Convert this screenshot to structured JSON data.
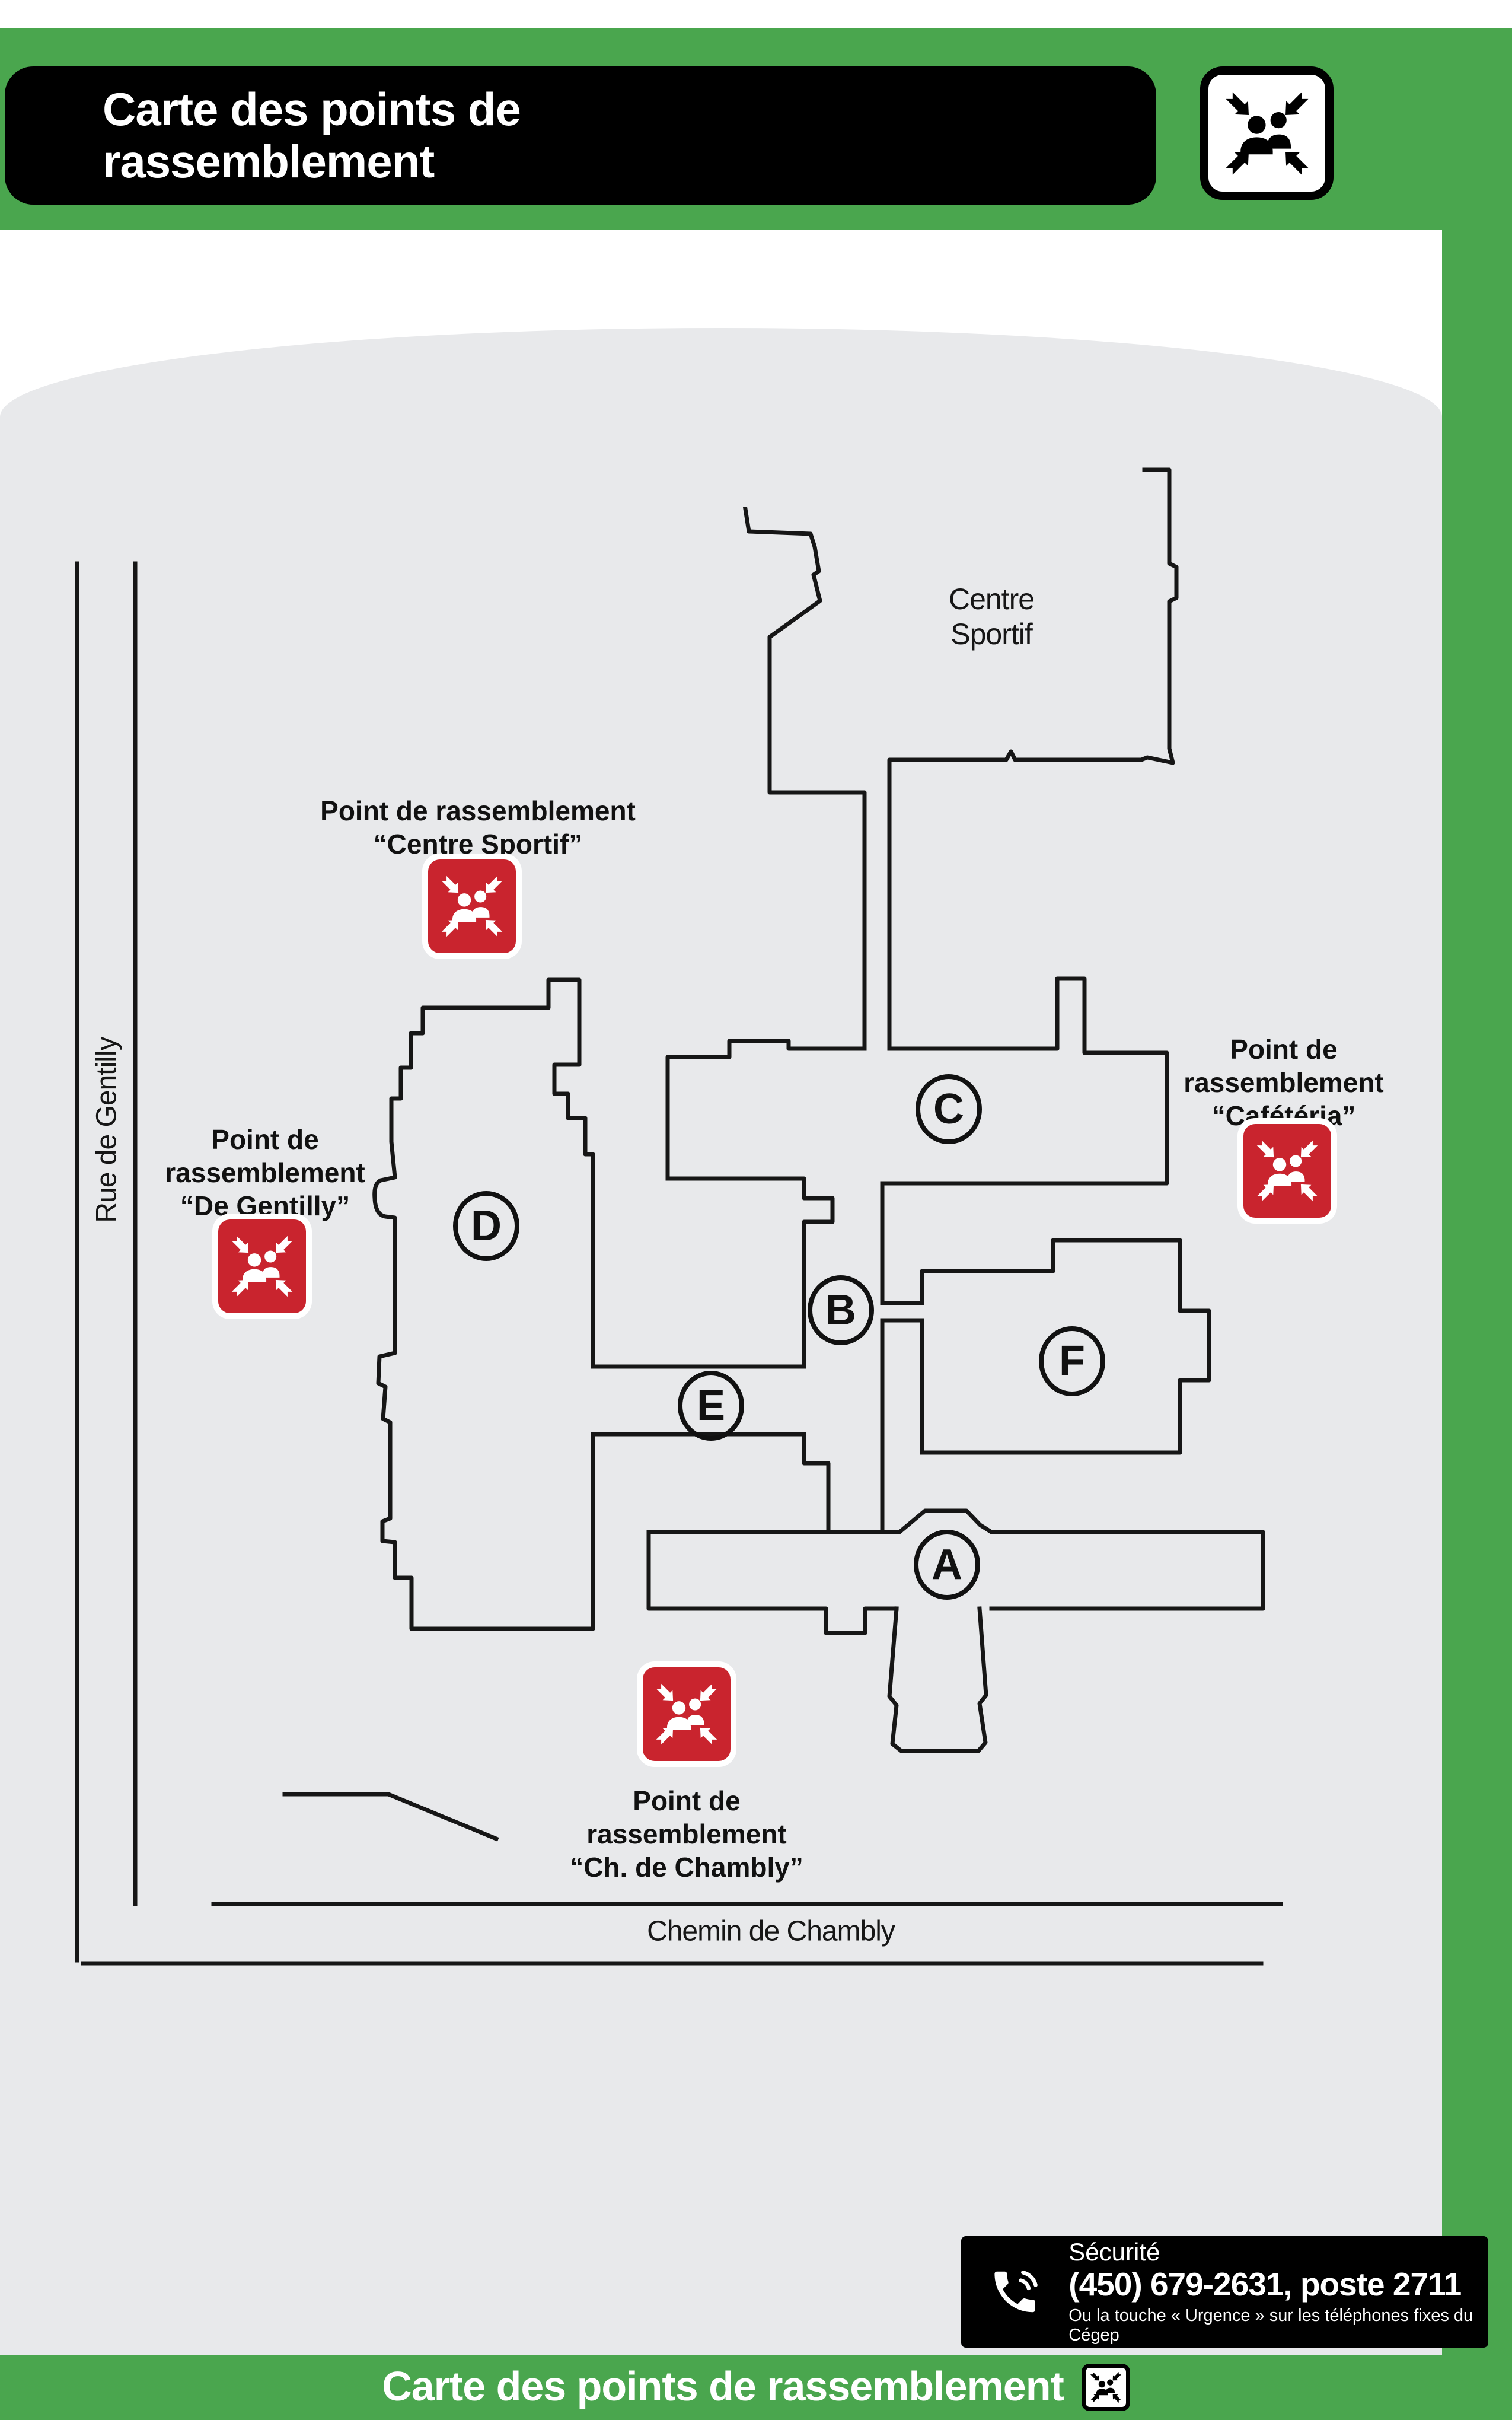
{
  "header": {
    "title_lines": [
      "Carte des points de",
      "rassemblement"
    ]
  },
  "map": {
    "place_label": "Centre\nSportif",
    "streets": {
      "vertical": "Rue de Gentilly",
      "horizontal": "Chemin de Chambly"
    },
    "buildings": [
      "A",
      "B",
      "C",
      "D",
      "E",
      "F"
    ],
    "assembly_points": {
      "centre_sportif": "Point de rassemblement\n“Centre Sportif”",
      "de_gentilly": "Point de\nrassemblement\n“De Gentilly”",
      "cafeteria": "Point de\nrassemblement\n“Cafétéria”",
      "chambly": "Point de\nrassemblement\n“Ch. de Chambly”"
    }
  },
  "security": {
    "title": "Sécurité",
    "phone": "(450) 679-2631, poste 2711",
    "note": "Ou la touche « Urgence » sur les téléphones fixes du Cégep"
  },
  "footer": {
    "title": "Carte des points de rassemblement"
  },
  "colors": {
    "green": "#4aa64e",
    "red": "#c9242e",
    "map_bg": "#e8e9eb",
    "ink": "#161616"
  }
}
